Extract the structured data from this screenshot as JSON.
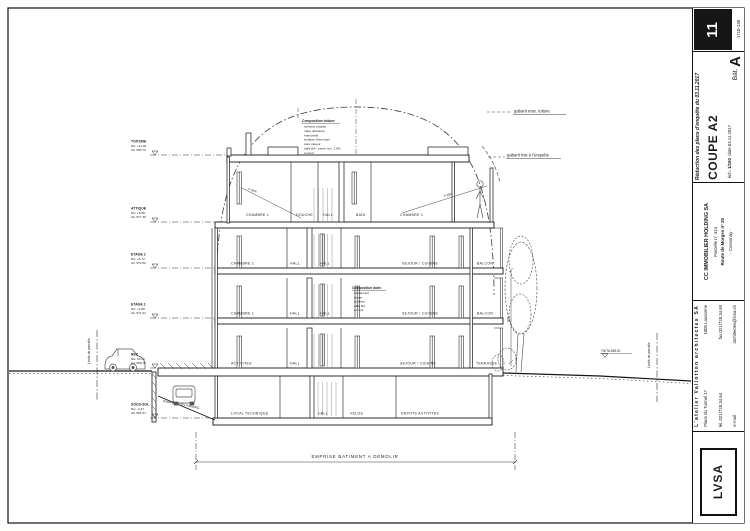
{
  "sheet": {
    "corner_number": "11",
    "project_number": "1710-138",
    "revision_note": "Réduction des plans d'enquête du 03.11.2017",
    "drawing_title": "COUPE A2",
    "building_prefix": "Bât.",
    "building_letter": "A",
    "scale_label": "éch.",
    "scale_value": "1/100",
    "date_label": "date",
    "date_value": "03.11.2017"
  },
  "client": {
    "name": "CC IMMOBILIER HOLDING SA",
    "parcel": "Parcelle n° 414",
    "street": "Route de Morges n° 25",
    "city": "- Cossonay -"
  },
  "architect": {
    "logo": "LVSA",
    "name": "L'atelier Vallotton architectes SA",
    "address": "Place du Tunnel 17",
    "city": "1005 Lausanne",
    "tel": "tél. 021/728.34.64",
    "fax": "fax 021/728.34.69",
    "email_label": "e-mail",
    "email": "architectes@lvsa.ch"
  },
  "levels": [
    {
      "name": "TOITURE",
      "niv": "Niv. +11.94",
      "alt": "Alt. 580.72"
    },
    {
      "name": "ATTIQUE",
      "niv": "Niv. +8.58",
      "alt": "Alt. 577.36"
    },
    {
      "name": "ETAGE 2",
      "niv": "Niv. +5.72",
      "alt": "Alt. 574.50"
    },
    {
      "name": "ETAGE 1",
      "niv": "Niv. +2.86",
      "alt": "Alt. 571.64"
    },
    {
      "name": "REZ",
      "niv": "Niv. ±0.00",
      "alt": "Alt. 568.78"
    },
    {
      "name": "SOUS-SOL",
      "niv": "Niv. -2.47",
      "alt": "Alt. 566.31"
    }
  ],
  "rooms": {
    "attique": [
      "CHAMBRE 1",
      "DOUCHE",
      "HALL",
      "BAIN",
      "CHAMBRE 1"
    ],
    "etage2": [
      "CHAMBRE 1",
      "HALL",
      "HALL",
      "SEJOUR / CUISINE",
      "BALCON"
    ],
    "etage1": [
      "CHAMBRE 1",
      "HALL",
      "HALL",
      "SEJOUR / CUISINE",
      "BALCON"
    ],
    "rez": [
      "ACTIVITES",
      "HALL",
      "SEJOUR / CUISINE",
      "TERRASSE"
    ],
    "sous_sol": [
      "LOCAL TECHNIQUE",
      "HALL",
      "VELOS",
      "DEPOTS ACTIVITES"
    ]
  },
  "notes": {
    "comp_toiture_title": "Composition toiture:",
    "comp_toiture": [
      "substrat végétal",
      "natte drainante",
      "étanchéité",
      "isolation thermique",
      "pare vapeur",
      "dalle BA - pente min. 1.5%",
      "en brut"
    ],
    "comp_dalle_title": "Composition dalle:",
    "comp_dalle": [
      "revêtement",
      "chape",
      "isolation",
      "dalle BA",
      "en brut"
    ]
  },
  "annotations": {
    "gabarit_max": "gabarit max. toiture",
    "gabarit_enquete": "gabarit mis à l'enquête",
    "emprise": "EMPRISE BATIMENT A DEMOLIR",
    "rampe": "RAMPE ACCES PARKING",
    "limite_parcelle_left": "Limite de parcelle",
    "limite_parcelle_right": "Limite de parcelle",
    "tn_ta": "TN/TA 568.00",
    "slope_left": "P 30%",
    "slope_right": "P 30%",
    "dim_facade": "920"
  }
}
